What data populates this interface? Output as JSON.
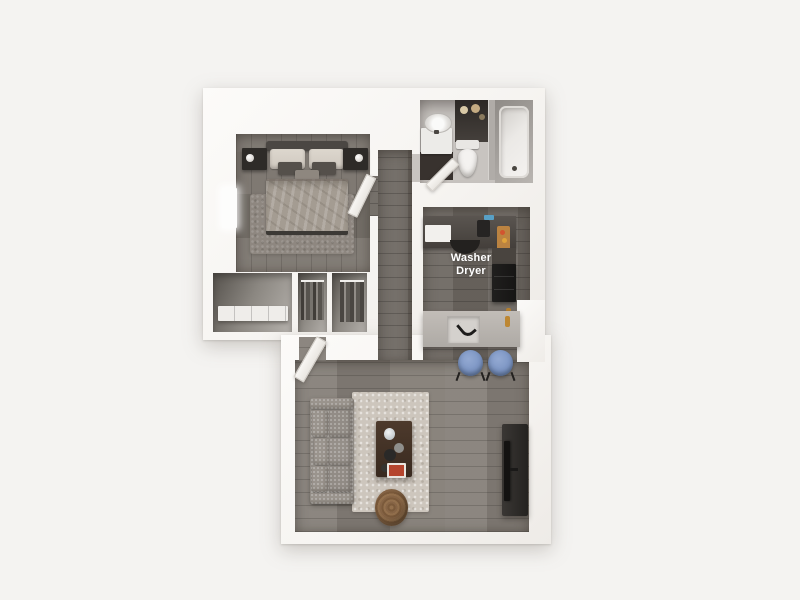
{
  "floorplan": {
    "appliance_label": {
      "line1": "Washer",
      "line2": "Dryer"
    },
    "colors": {
      "background": "#f4f3f1",
      "wall": "#faf8f6",
      "bedroom_floor": "#7b756e",
      "hall_floor": "#6e6862",
      "living_floor": "#857f78",
      "bathroom_floor": "#c8c4c0",
      "counter_dark": "#55504b",
      "island_top": "#b8b3ae",
      "stool_blue": "#7d96c4",
      "sofa_gray": "#8f8a84",
      "rug_living": "#cdc6bd",
      "coffee_table_brown": "#4d3a2c",
      "pouf_wicker": "#8a6747",
      "label_text": "#ffffff"
    }
  }
}
